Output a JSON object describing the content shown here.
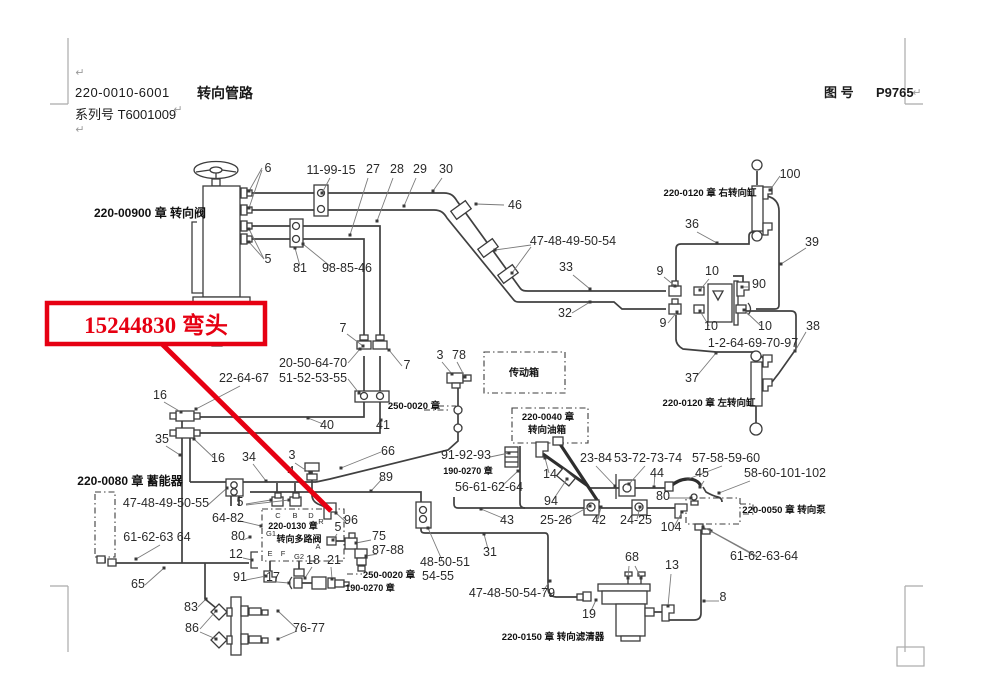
{
  "header": {
    "doc_number": "220-0010-6001",
    "doc_title": "转向管路",
    "serial_line": "系列号  T6001009",
    "figure_label": "图 号",
    "figure_number": "P9765",
    "paragraph_mark": "↵"
  },
  "callout": {
    "label": "15244830  弯头",
    "part_number": "15244830",
    "part_name": "弯头",
    "color": "#e60012"
  },
  "colors": {
    "pipe": "#404040",
    "hose": "#2e2e2e",
    "leader": "#7a7a7a",
    "label_text": "#2a2a2a",
    "chapter_text": "#111111",
    "crop_mark": "#ababab",
    "callout_red": "#e60012"
  },
  "diagram": {
    "chapters": [
      [
        150,
        217,
        12,
        "220-00900 章  转向阀"
      ],
      [
        710,
        196,
        9.5,
        "220-0120 章  右转向缸"
      ],
      [
        709,
        406,
        9.5,
        "220-0120 章  左转向缸"
      ],
      [
        524,
        376,
        10,
        "传动箱"
      ],
      [
        548,
        420,
        9.5,
        "220-0040 章"
      ],
      [
        547,
        433,
        9.5,
        "转向油箱"
      ],
      [
        414,
        409,
        9.5,
        "250-0020 章"
      ],
      [
        468,
        474,
        9,
        "190-0270 章"
      ],
      [
        130,
        485,
        12,
        "220-0080 章  蓄能器"
      ],
      [
        293,
        529,
        9,
        "220-0130 章"
      ],
      [
        299,
        542,
        9,
        "转向多路阀"
      ],
      [
        389,
        578,
        9.5,
        "250-0020 章"
      ],
      [
        370,
        591,
        9,
        "190-0270 章"
      ],
      [
        784,
        513,
        9.5,
        "220-0050 章  转向泵"
      ],
      [
        553,
        640,
        9.5,
        "220-0150 章  转向滤清器"
      ]
    ],
    "labels": [
      [
        268,
        172,
        "6"
      ],
      [
        331,
        174,
        "11-99-15"
      ],
      [
        373,
        173,
        "27"
      ],
      [
        397,
        173,
        "28"
      ],
      [
        420,
        173,
        "29"
      ],
      [
        446,
        173,
        "30"
      ],
      [
        515,
        209,
        "46"
      ],
      [
        573,
        245,
        "47-48-49-50-54"
      ],
      [
        566,
        271,
        "33"
      ],
      [
        565,
        317,
        "32"
      ],
      [
        790,
        178,
        "100"
      ],
      [
        692,
        228,
        "36"
      ],
      [
        812,
        246,
        "39"
      ],
      [
        660,
        275,
        "9"
      ],
      [
        712,
        275,
        "10"
      ],
      [
        759,
        288,
        "90"
      ],
      [
        663,
        327,
        "9"
      ],
      [
        711,
        330,
        "10"
      ],
      [
        765,
        330,
        "10"
      ],
      [
        813,
        330,
        "38"
      ],
      [
        753,
        347,
        "1-2-64-69-70-97"
      ],
      [
        692,
        382,
        "37"
      ],
      [
        268,
        263,
        "5"
      ],
      [
        300,
        272,
        "81"
      ],
      [
        347,
        272,
        "98-85-46"
      ],
      [
        343,
        332,
        "7"
      ],
      [
        407,
        369,
        "7"
      ],
      [
        313,
        367,
        "20-50-64-70"
      ],
      [
        313,
        382,
        "51-52-53-55"
      ],
      [
        244,
        382,
        "22-64-67"
      ],
      [
        160,
        399,
        "16"
      ],
      [
        327,
        429,
        "40"
      ],
      [
        383,
        429,
        "41"
      ],
      [
        162,
        443,
        "35"
      ],
      [
        218,
        462,
        "16"
      ],
      [
        249,
        461,
        "34"
      ],
      [
        292,
        459,
        "3"
      ],
      [
        291,
        475,
        "4"
      ],
      [
        440,
        359,
        "3"
      ],
      [
        459,
        359,
        "78"
      ],
      [
        466,
        459,
        "91-92-93"
      ],
      [
        489,
        491,
        "56-61-62-64"
      ],
      [
        596,
        462,
        "23-84"
      ],
      [
        648,
        462,
        "53-72-73-74"
      ],
      [
        657,
        477,
        "44"
      ],
      [
        726,
        462,
        "57-58-59-60"
      ],
      [
        702,
        477,
        "45"
      ],
      [
        785,
        477,
        "58-60-101-102"
      ],
      [
        663,
        500,
        "80"
      ],
      [
        550,
        478,
        "14"
      ],
      [
        551,
        505,
        "94"
      ],
      [
        556,
        524,
        "25-26"
      ],
      [
        599,
        524,
        "42"
      ],
      [
        636,
        524,
        "24-25"
      ],
      [
        671,
        531,
        "104"
      ],
      [
        507,
        524,
        "43"
      ],
      [
        388,
        455,
        "66"
      ],
      [
        386,
        481,
        "89"
      ],
      [
        166,
        507,
        "47-48-49-50-55"
      ],
      [
        240,
        506,
        "5"
      ],
      [
        228,
        522,
        "64-82"
      ],
      [
        157,
        541,
        "61-62-63 64"
      ],
      [
        238,
        540,
        "80"
      ],
      [
        236,
        558,
        "12"
      ],
      [
        240,
        581,
        "91"
      ],
      [
        273,
        581,
        "17"
      ],
      [
        351,
        524,
        "96"
      ],
      [
        338,
        531,
        "5"
      ],
      [
        379,
        540,
        "75"
      ],
      [
        388,
        554,
        "87-88"
      ],
      [
        334,
        564,
        "21"
      ],
      [
        313,
        564,
        "18"
      ],
      [
        445,
        566,
        "48-50-51"
      ],
      [
        438,
        580,
        "54-55"
      ],
      [
        490,
        556,
        "31"
      ],
      [
        512,
        597,
        "47-48-50-54-79"
      ],
      [
        632,
        561,
        "68"
      ],
      [
        672,
        569,
        "13"
      ],
      [
        589,
        618,
        "19"
      ],
      [
        723,
        601,
        "8"
      ],
      [
        764,
        560,
        "61-62-63-64"
      ],
      [
        138,
        588,
        "65"
      ],
      [
        191,
        611,
        "83"
      ],
      [
        192,
        632,
        "86"
      ],
      [
        309,
        632,
        "76-77"
      ]
    ],
    "ports": [
      [
        278,
        518,
        "C"
      ],
      [
        295,
        518,
        "B"
      ],
      [
        311,
        518,
        "D"
      ],
      [
        321,
        524,
        "R"
      ],
      [
        271,
        536,
        "G1"
      ],
      [
        318,
        549,
        "A"
      ],
      [
        270,
        556,
        "E"
      ],
      [
        283,
        556,
        "F"
      ],
      [
        299,
        559,
        "G2"
      ]
    ],
    "leaders": [
      [
        262,
        168,
        249,
        191
      ],
      [
        262,
        170,
        249,
        208
      ],
      [
        330,
        178,
        322,
        193
      ],
      [
        368,
        178,
        350,
        235
      ],
      [
        393,
        178,
        377,
        221
      ],
      [
        416,
        178,
        404,
        206
      ],
      [
        442,
        178,
        433,
        191
      ],
      [
        504,
        205,
        476,
        204
      ],
      [
        531,
        245,
        495,
        250
      ],
      [
        531,
        247,
        512,
        273
      ],
      [
        573,
        275,
        590,
        289
      ],
      [
        572,
        313,
        590,
        302
      ],
      [
        780,
        176,
        770,
        190
      ],
      [
        697,
        232,
        717,
        243
      ],
      [
        806,
        248,
        781,
        264
      ],
      [
        664,
        277,
        675,
        286
      ],
      [
        709,
        279,
        700,
        290
      ],
      [
        750,
        287,
        742,
        287
      ],
      [
        668,
        323,
        677,
        312
      ],
      [
        709,
        326,
        700,
        311
      ],
      [
        761,
        326,
        744,
        310
      ],
      [
        806,
        332,
        795,
        351
      ],
      [
        696,
        377,
        716,
        353
      ],
      [
        264,
        259,
        249,
        229
      ],
      [
        264,
        259,
        249,
        242
      ],
      [
        300,
        266,
        295,
        248
      ],
      [
        330,
        266,
        303,
        244
      ],
      [
        347,
        334,
        363,
        346
      ],
      [
        402,
        366,
        389,
        350
      ],
      [
        348,
        363,
        360,
        349
      ],
      [
        348,
        379,
        359,
        393
      ],
      [
        240,
        386,
        196,
        409
      ],
      [
        164,
        402,
        181,
        412
      ],
      [
        323,
        424,
        308,
        418
      ],
      [
        379,
        425,
        381,
        420
      ],
      [
        166,
        446,
        180,
        455
      ],
      [
        214,
        458,
        194,
        439
      ],
      [
        253,
        464,
        266,
        481
      ],
      [
        295,
        463,
        310,
        473
      ],
      [
        442,
        362,
        452,
        374
      ],
      [
        457,
        362,
        465,
        377
      ],
      [
        490,
        457,
        509,
        453
      ],
      [
        502,
        486,
        518,
        471
      ],
      [
        549,
        473,
        545,
        458
      ],
      [
        553,
        500,
        567,
        479
      ],
      [
        596,
        466,
        615,
        486
      ],
      [
        645,
        466,
        629,
        484
      ],
      [
        655,
        473,
        654,
        487
      ],
      [
        722,
        466,
        688,
        479
      ],
      [
        704,
        481,
        700,
        487
      ],
      [
        750,
        481,
        719,
        493
      ],
      [
        668,
        498,
        691,
        498
      ],
      [
        674,
        527,
        682,
        512
      ],
      [
        637,
        519,
        640,
        507
      ],
      [
        598,
        519,
        601,
        507
      ],
      [
        563,
        521,
        590,
        506
      ],
      [
        505,
        519,
        481,
        509
      ],
      [
        381,
        452,
        341,
        468
      ],
      [
        383,
        478,
        371,
        491
      ],
      [
        346,
        522,
        336,
        513
      ],
      [
        337,
        534,
        333,
        540
      ],
      [
        371,
        540,
        356,
        543
      ],
      [
        377,
        554,
        366,
        556
      ],
      [
        331,
        567,
        332,
        579
      ],
      [
        312,
        567,
        305,
        578
      ],
      [
        277,
        582,
        289,
        583
      ],
      [
        246,
        580,
        266,
        576
      ],
      [
        243,
        558,
        252,
        560
      ],
      [
        243,
        540,
        250,
        537
      ],
      [
        240,
        521,
        261,
        526
      ],
      [
        208,
        505,
        227,
        488
      ],
      [
        246,
        504,
        271,
        500
      ],
      [
        246,
        505,
        289,
        500
      ],
      [
        160,
        545,
        136,
        559
      ],
      [
        145,
        585,
        164,
        568
      ],
      [
        198,
        607,
        206,
        599
      ],
      [
        200,
        629,
        216,
        611
      ],
      [
        200,
        632,
        216,
        639
      ],
      [
        297,
        629,
        278,
        611
      ],
      [
        297,
        631,
        278,
        639
      ],
      [
        442,
        560,
        428,
        528
      ],
      [
        488,
        549,
        484,
        534
      ],
      [
        543,
        591,
        550,
        581
      ],
      [
        629,
        566,
        628,
        578
      ],
      [
        635,
        566,
        641,
        578
      ],
      [
        671,
        574,
        668,
        606
      ],
      [
        590,
        613,
        596,
        600
      ],
      [
        719,
        601,
        704,
        601
      ],
      [
        757,
        556,
        711,
        531
      ],
      [
        757,
        557,
        703,
        527
      ]
    ],
    "paragraph_marks": [
      [
        80,
        76
      ],
      [
        178,
        113
      ],
      [
        80,
        133
      ],
      [
        917,
        96
      ]
    ]
  }
}
